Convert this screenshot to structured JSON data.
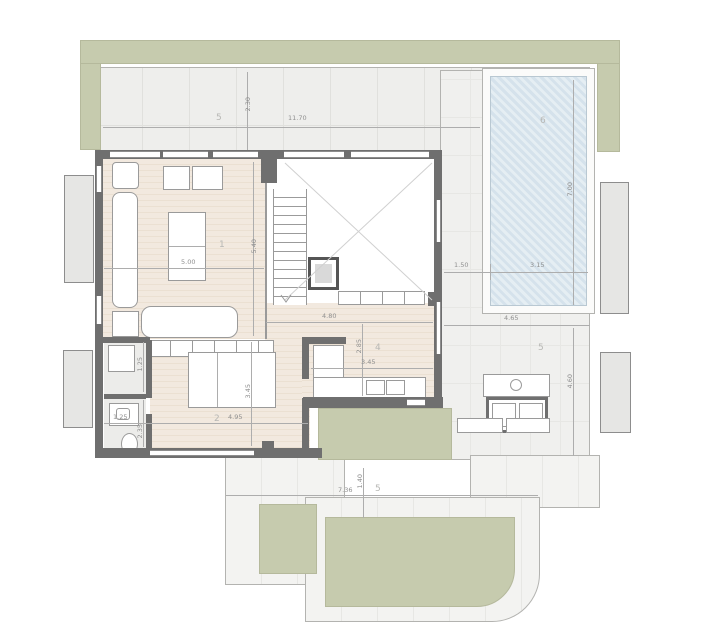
{
  "plan": {
    "type": "architectural-floor-plan",
    "colors": {
      "garden": "#c6cbae",
      "pool": "#dbe7ef",
      "wood_floor": "#f1e8dd",
      "wall": "#6f6f6f",
      "terrace": "#efefed",
      "dim_text": "#8f8f8f",
      "room_text": "#b7b7b4"
    },
    "rooms": [
      {
        "id": "terrace-top",
        "label": "5"
      },
      {
        "id": "living-room",
        "label": "1"
      },
      {
        "id": "pool",
        "label": "6"
      },
      {
        "id": "terrace-right",
        "label": "5"
      },
      {
        "id": "kitchen",
        "label": "4"
      },
      {
        "id": "bedroom",
        "label": "2"
      },
      {
        "id": "terrace-bottom",
        "label": "5"
      }
    ],
    "dims": [
      {
        "text": "2.30"
      },
      {
        "text": "11.70"
      },
      {
        "text": "5.00"
      },
      {
        "text": "5.40"
      },
      {
        "text": "4.80"
      },
      {
        "text": "2.85"
      },
      {
        "text": "3.45"
      },
      {
        "text": "1.50"
      },
      {
        "text": "3.15"
      },
      {
        "text": "7.00"
      },
      {
        "text": "4.65"
      },
      {
        "text": "4.60"
      },
      {
        "text": "4.95"
      },
      {
        "text": "1.25"
      },
      {
        "text": "2.35"
      },
      {
        "text": "3.45"
      },
      {
        "text": "1.25"
      },
      {
        "text": "7.36"
      },
      {
        "text": "1.40"
      }
    ]
  }
}
